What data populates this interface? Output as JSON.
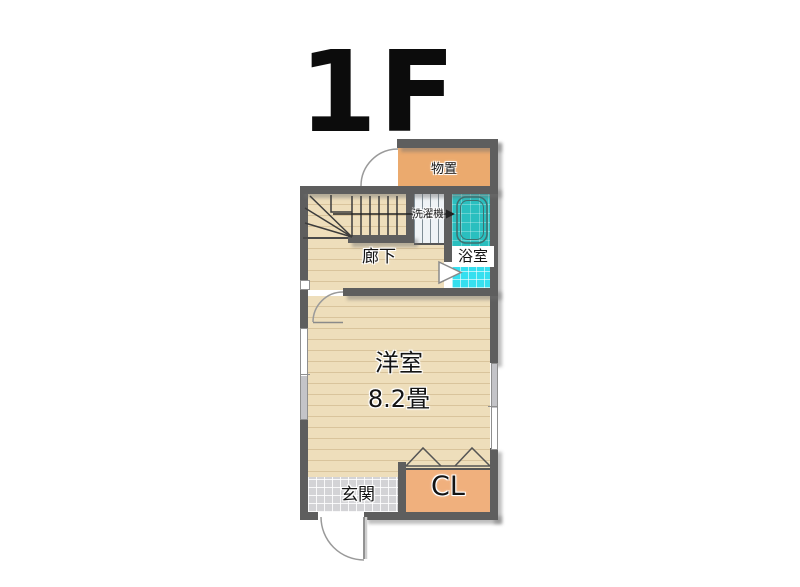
{
  "title": "1F",
  "rooms": {
    "storage": {
      "label": "物置"
    },
    "laundry": {
      "label": "洗濯機"
    },
    "bath": {
      "label": "浴室"
    },
    "hallway": {
      "label": "廊下"
    },
    "western_room": {
      "label": "洋室",
      "size": "8.2畳"
    },
    "entrance": {
      "label": "玄関"
    },
    "closet": {
      "label": "CL"
    }
  },
  "colors": {
    "wall": "#5e5e5e",
    "wood_floor": "#eedebb",
    "wood_stripe": "#d9c49c",
    "storage": "#ebaa6e",
    "closet": "#f0b07d",
    "bath_floor": "#35dfef",
    "bathtub_zone": "#2abfbf",
    "entrance_tile": "#d3d3d6",
    "laundry_area": "#eff3f6",
    "title_text": "#0c0c0c"
  }
}
